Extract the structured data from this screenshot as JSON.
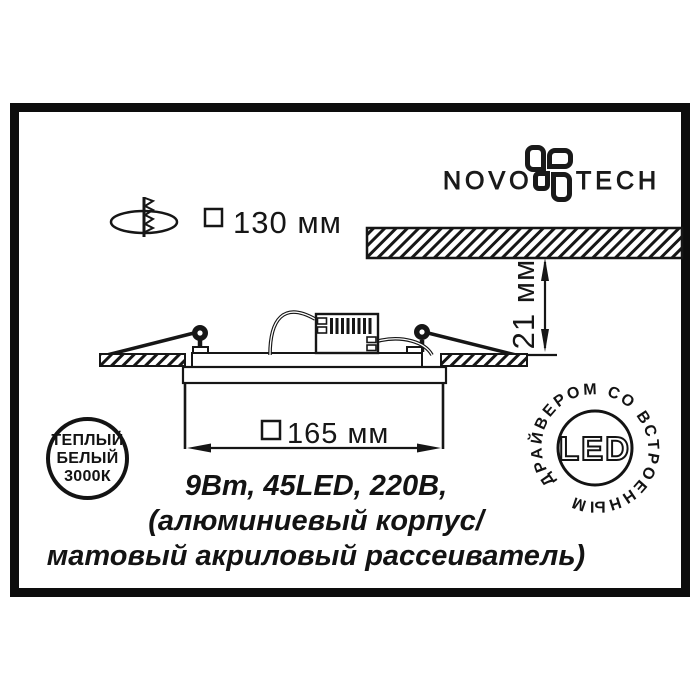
{
  "brand": {
    "word_left": "NOVO",
    "word_right": "TECH",
    "logo_icon": "novotech-flower-icon"
  },
  "dimensions": {
    "cutout": {
      "symbol": "□",
      "value": "130 мм",
      "icon": "screw-in-hole-icon"
    },
    "recess_depth": {
      "value": "21 мм"
    },
    "body_width": {
      "symbol": "□",
      "value": "165 мм"
    }
  },
  "specs": {
    "line1": "9Вт, 45LED, 220В,",
    "line2": "(алюминиевый корпус/",
    "line3": "матовый акриловый рассеиватель)"
  },
  "badges": {
    "warm_white": {
      "line1": "ТЕПЛЫЙ",
      "line2": "БЕЛЫЙ",
      "line3": "3000К"
    },
    "led_driver": {
      "center_label": "LED",
      "ring_text": "ДРАЙВЕРОМ СО ВСТРОЕННЫМ"
    }
  },
  "colors": {
    "ink": "#161616",
    "background": "#ffffff"
  }
}
